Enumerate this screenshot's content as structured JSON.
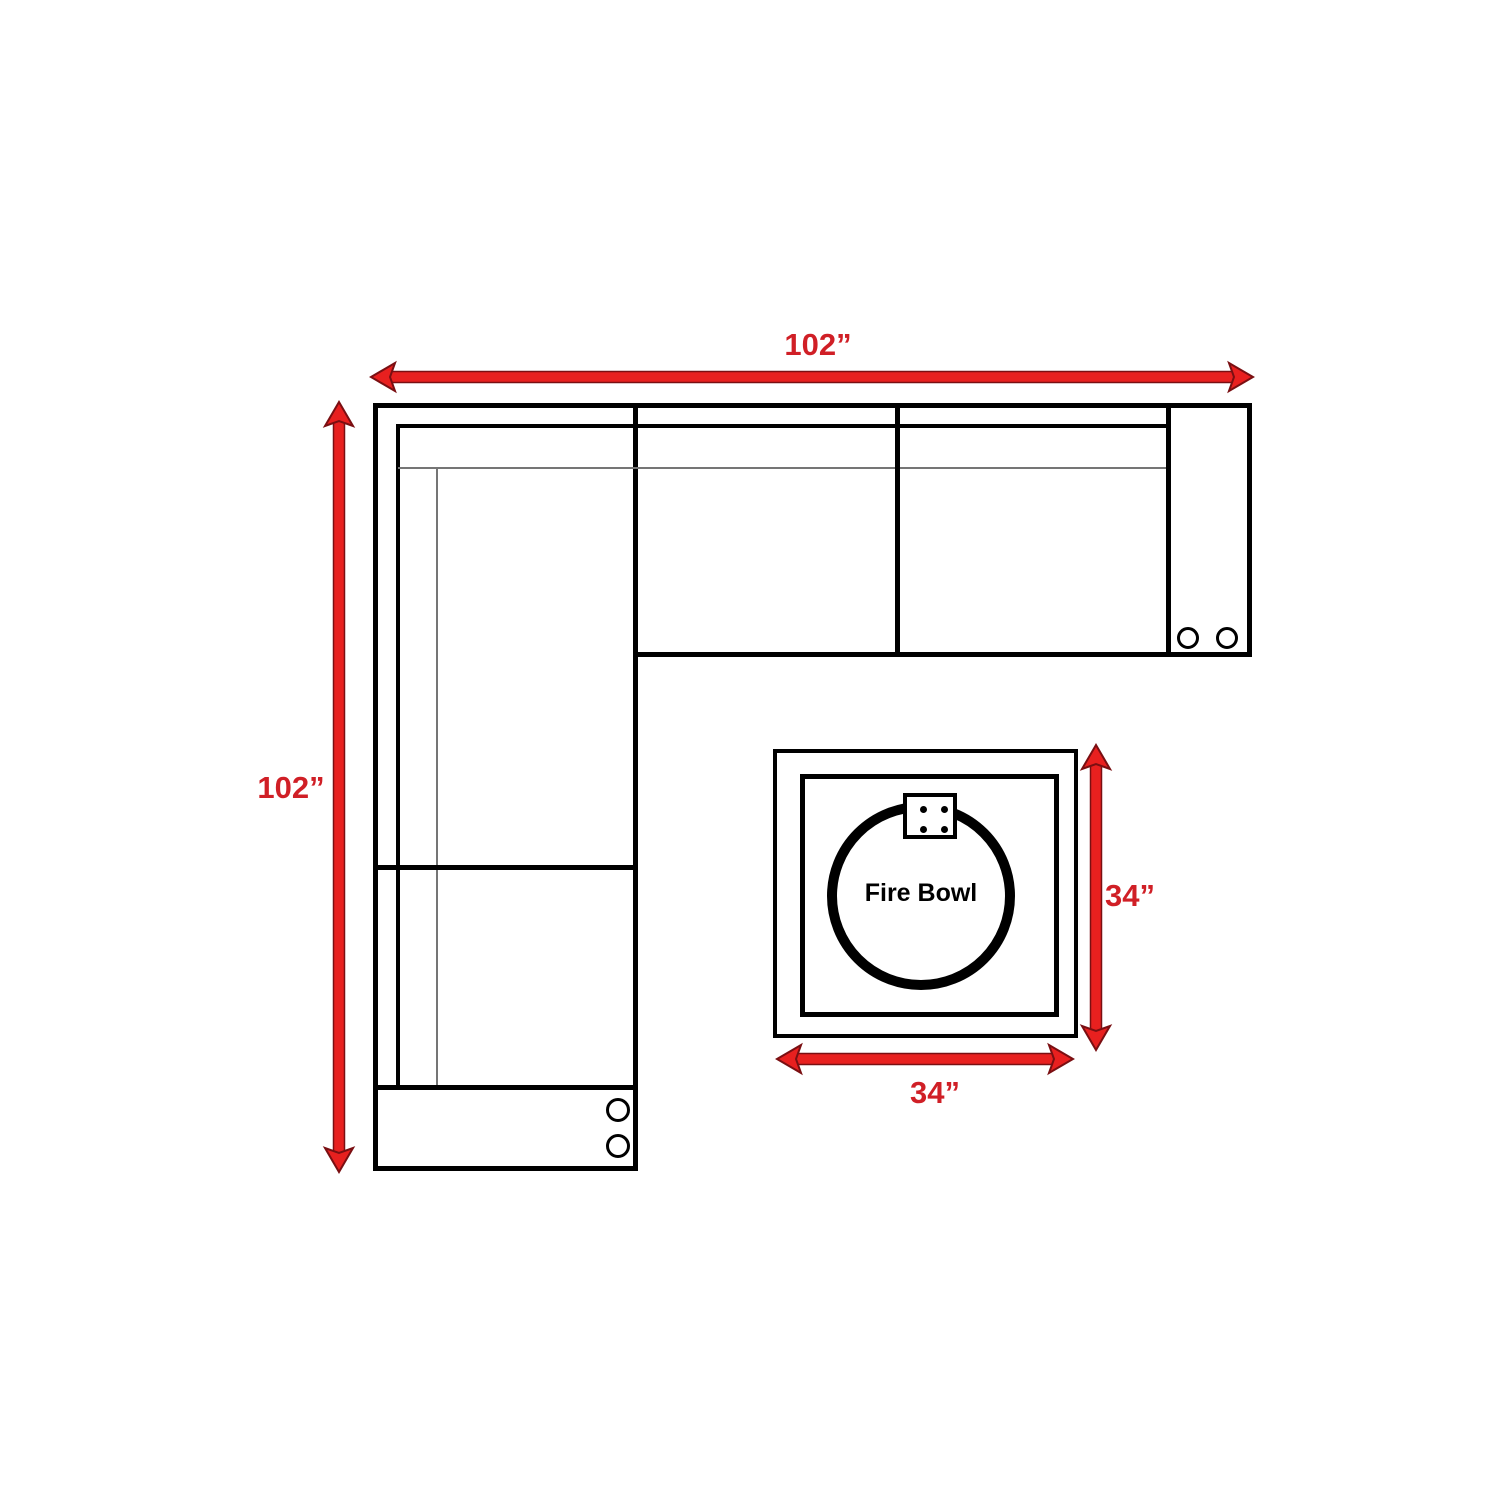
{
  "diagram": {
    "type": "furniture-dimension-floor-plan",
    "sofa": {
      "description": "L-shaped sectional sofa outline with corner section, three seats per run, and two arm panels with cup holders",
      "width_label": "102”",
      "height_label": "102”",
      "cup_holders_per_arm": 2
    },
    "fire_table": {
      "name_label": "Fire Bowl",
      "width_label": "34”",
      "height_label": "34”"
    },
    "colors": {
      "background": "#ffffff",
      "sofa_line": "#000000",
      "thin_seat_line": "#757575",
      "arrow_fill": "#e8201f",
      "arrow_outline": "#7a0f12",
      "dimension_label": "#d01f26",
      "fire_bowl_text": "#000000"
    }
  }
}
